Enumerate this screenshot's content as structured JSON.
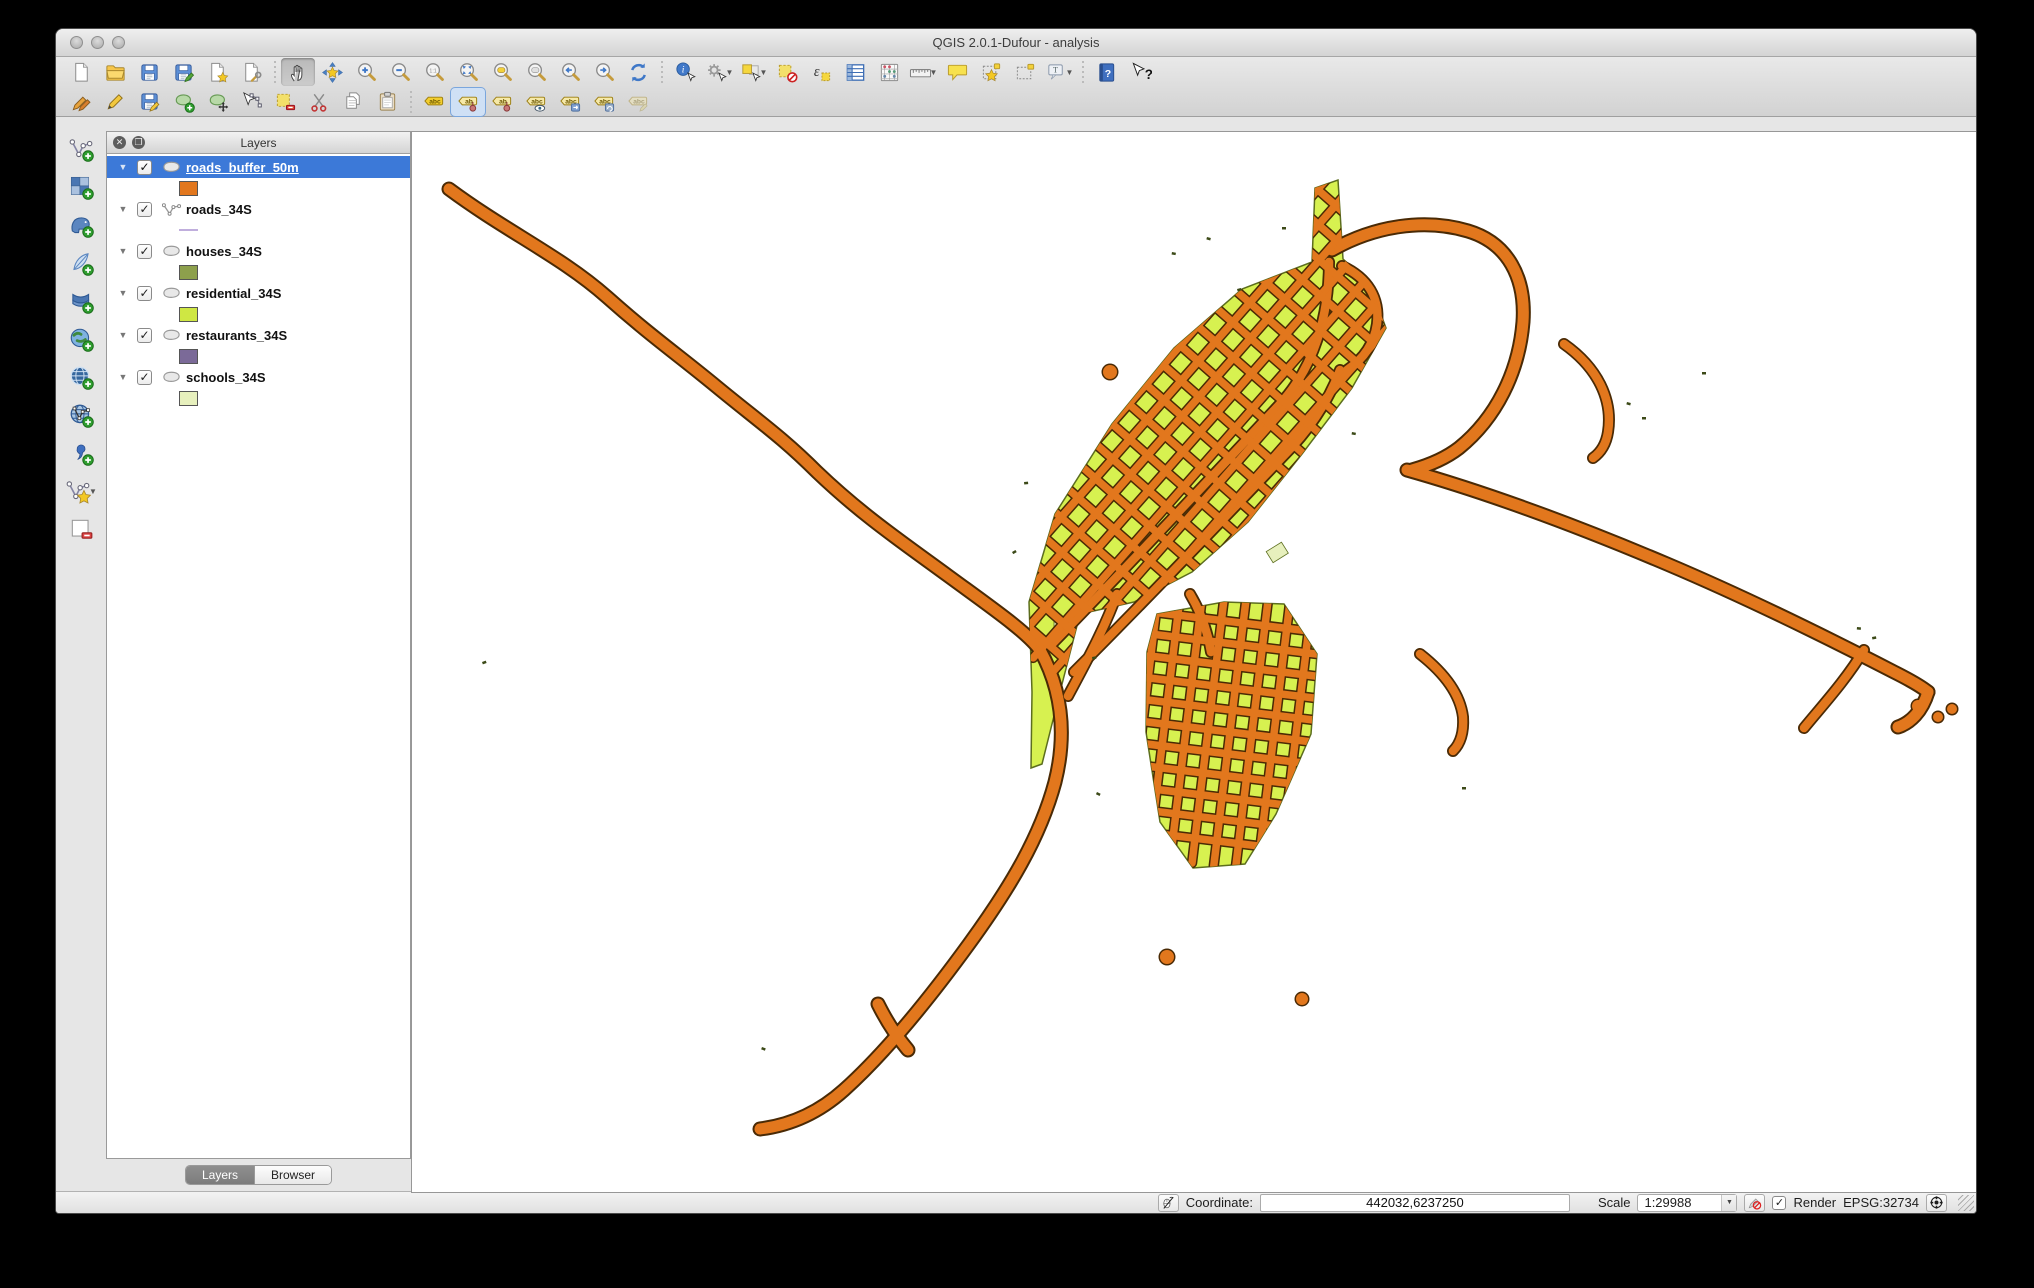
{
  "window": {
    "title": "QGIS 2.0.1-Dufour - analysis"
  },
  "toolbars": {
    "row1": [
      {
        "name": "new-project"
      },
      {
        "name": "open-project"
      },
      {
        "name": "save-project"
      },
      {
        "name": "save-project-as"
      },
      {
        "name": "new-composer"
      },
      {
        "name": "composer-manager"
      },
      {
        "sep": true
      },
      {
        "name": "pan-map",
        "active": true
      },
      {
        "name": "pan-to-selection"
      },
      {
        "name": "zoom-in"
      },
      {
        "name": "zoom-out"
      },
      {
        "name": "zoom-native"
      },
      {
        "name": "zoom-full"
      },
      {
        "name": "zoom-selection"
      },
      {
        "name": "zoom-layer"
      },
      {
        "name": "zoom-last"
      },
      {
        "name": "zoom-next"
      },
      {
        "name": "refresh"
      },
      {
        "sep": true
      },
      {
        "name": "identify"
      },
      {
        "name": "feature-action",
        "dropdown": true
      },
      {
        "name": "select-features",
        "dropdown": true
      },
      {
        "name": "deselect-features"
      },
      {
        "name": "select-expression"
      },
      {
        "name": "attribute-table"
      },
      {
        "name": "field-calculator"
      },
      {
        "name": "measure",
        "dropdown": true
      },
      {
        "name": "map-tips"
      },
      {
        "name": "new-bookmark"
      },
      {
        "name": "show-bookmarks"
      },
      {
        "name": "text-annotation",
        "dropdown": true
      },
      {
        "sep": true
      },
      {
        "name": "help"
      },
      {
        "name": "whats-this"
      }
    ],
    "row2": [
      {
        "name": "current-edits"
      },
      {
        "name": "toggle-editing"
      },
      {
        "name": "save-edits"
      },
      {
        "name": "add-feature"
      },
      {
        "name": "move-feature"
      },
      {
        "name": "node-tool"
      },
      {
        "name": "delete-selected"
      },
      {
        "name": "cut-features"
      },
      {
        "name": "copy-features"
      },
      {
        "name": "paste-features"
      },
      {
        "sep": true
      },
      {
        "name": "label-options"
      },
      {
        "name": "pin-labels",
        "selected": true
      },
      {
        "name": "highlight-pinned"
      },
      {
        "name": "show-hide-labels"
      },
      {
        "name": "move-label"
      },
      {
        "name": "rotate-label"
      },
      {
        "name": "change-label",
        "disabled": true
      }
    ],
    "side": [
      {
        "name": "add-vector-layer"
      },
      {
        "name": "add-raster-layer"
      },
      {
        "name": "add-postgis-layer"
      },
      {
        "name": "add-spatialite-layer"
      },
      {
        "name": "add-mssql-layer"
      },
      {
        "name": "add-wms-layer"
      },
      {
        "name": "add-wcs-layer"
      },
      {
        "name": "add-wfs-layer"
      },
      {
        "name": "add-delimited-text-layer"
      },
      {
        "name": "new-shapefile-layer",
        "dropdown": true
      },
      {
        "name": "remove-layer"
      }
    ]
  },
  "layers_panel": {
    "title": "Layers",
    "tabs": [
      {
        "label": "Layers",
        "active": true
      },
      {
        "label": "Browser",
        "active": false
      }
    ],
    "layers": [
      {
        "name": "roads_buffer_50m",
        "checked": true,
        "selected": true,
        "type": "polygon",
        "swatch": "#e2771d"
      },
      {
        "name": "roads_34S",
        "checked": true,
        "selected": false,
        "type": "line",
        "swatch": "#c0aedd"
      },
      {
        "name": "houses_34S",
        "checked": true,
        "selected": false,
        "type": "polygon",
        "swatch": "#8da04c"
      },
      {
        "name": "residential_34S",
        "checked": true,
        "selected": false,
        "type": "polygon",
        "swatch": "#cfe743"
      },
      {
        "name": "restaurants_34S",
        "checked": true,
        "selected": false,
        "type": "polygon",
        "swatch": "#7b6a98"
      },
      {
        "name": "schools_34S",
        "checked": true,
        "selected": false,
        "type": "polygon",
        "swatch": "#e7f0bd"
      }
    ]
  },
  "statusbar": {
    "coordinate_label": "Coordinate:",
    "coordinate_value": "442032,6237250",
    "scale_label": "Scale",
    "scale_value": "1:29988",
    "render_label": "Render",
    "crs_text": "EPSG:32734"
  },
  "map": {
    "colors": {
      "road_fill": "#e2771d",
      "road_stroke": "#4a2a05",
      "residential_fill": "#d7f150",
      "residential_stroke": "#5c6e1e",
      "schools_fill": "#e7f0bd",
      "speck": "#3c4a18"
    }
  }
}
